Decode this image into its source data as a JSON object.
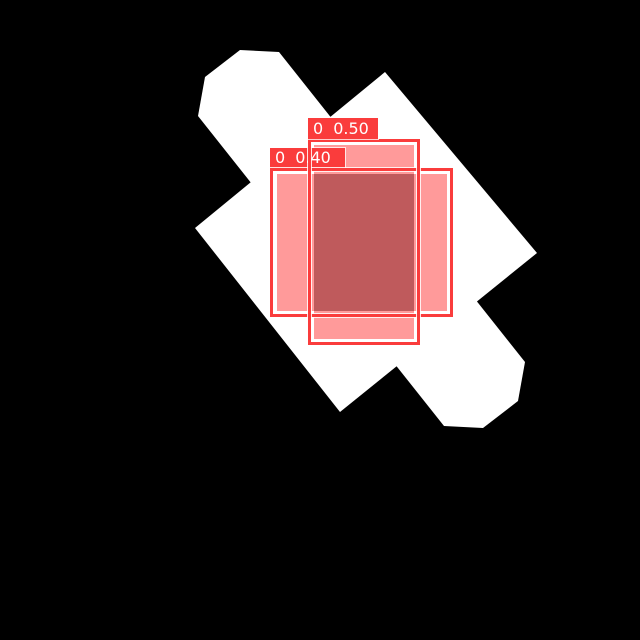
{
  "canvas": {
    "width": 640,
    "height": 640,
    "background": "#000000"
  },
  "object": {
    "name": "white-rotated-part",
    "color": "#ffffff",
    "diamond_points": "195,228 385,72 537,253 340,412",
    "bar_points": "205,77 240,50 279,52 525,362 518,401 483,428 444,426 198,116"
  },
  "colors": {
    "box_border": "#fa3c3c",
    "label_background": "#fa3c3c",
    "label_text": "#ffffff",
    "single_fill": "#ff9a9a",
    "overlap_fill": "#bf5a5c",
    "background": "#000000",
    "object": "#ffffff"
  },
  "detections": [
    {
      "class_id": "0",
      "score": "0.50",
      "color": "#fa3c3c",
      "box": {
        "left": 308,
        "top": 139,
        "width": 112,
        "height": 206
      },
      "tab": {
        "left": 308,
        "top": 118,
        "width": 70,
        "height": 21
      },
      "fill": {
        "left": 314,
        "top": 145,
        "width": 100,
        "height": 194,
        "color": "#ff9a9a"
      }
    },
    {
      "class_id": "0",
      "score": "0.40",
      "color": "#fa3c3c",
      "box": {
        "left": 270,
        "top": 168,
        "width": 183,
        "height": 149
      },
      "tab": {
        "left": 270,
        "top": 148,
        "width": 75,
        "height": 20
      },
      "fill": {
        "left": 277,
        "top": 174,
        "width": 170,
        "height": 137,
        "color": "#ff9a9a"
      }
    }
  ],
  "overlap": {
    "left": 314,
    "top": 174,
    "width": 100,
    "height": 137,
    "color": "#bf5a5c"
  }
}
